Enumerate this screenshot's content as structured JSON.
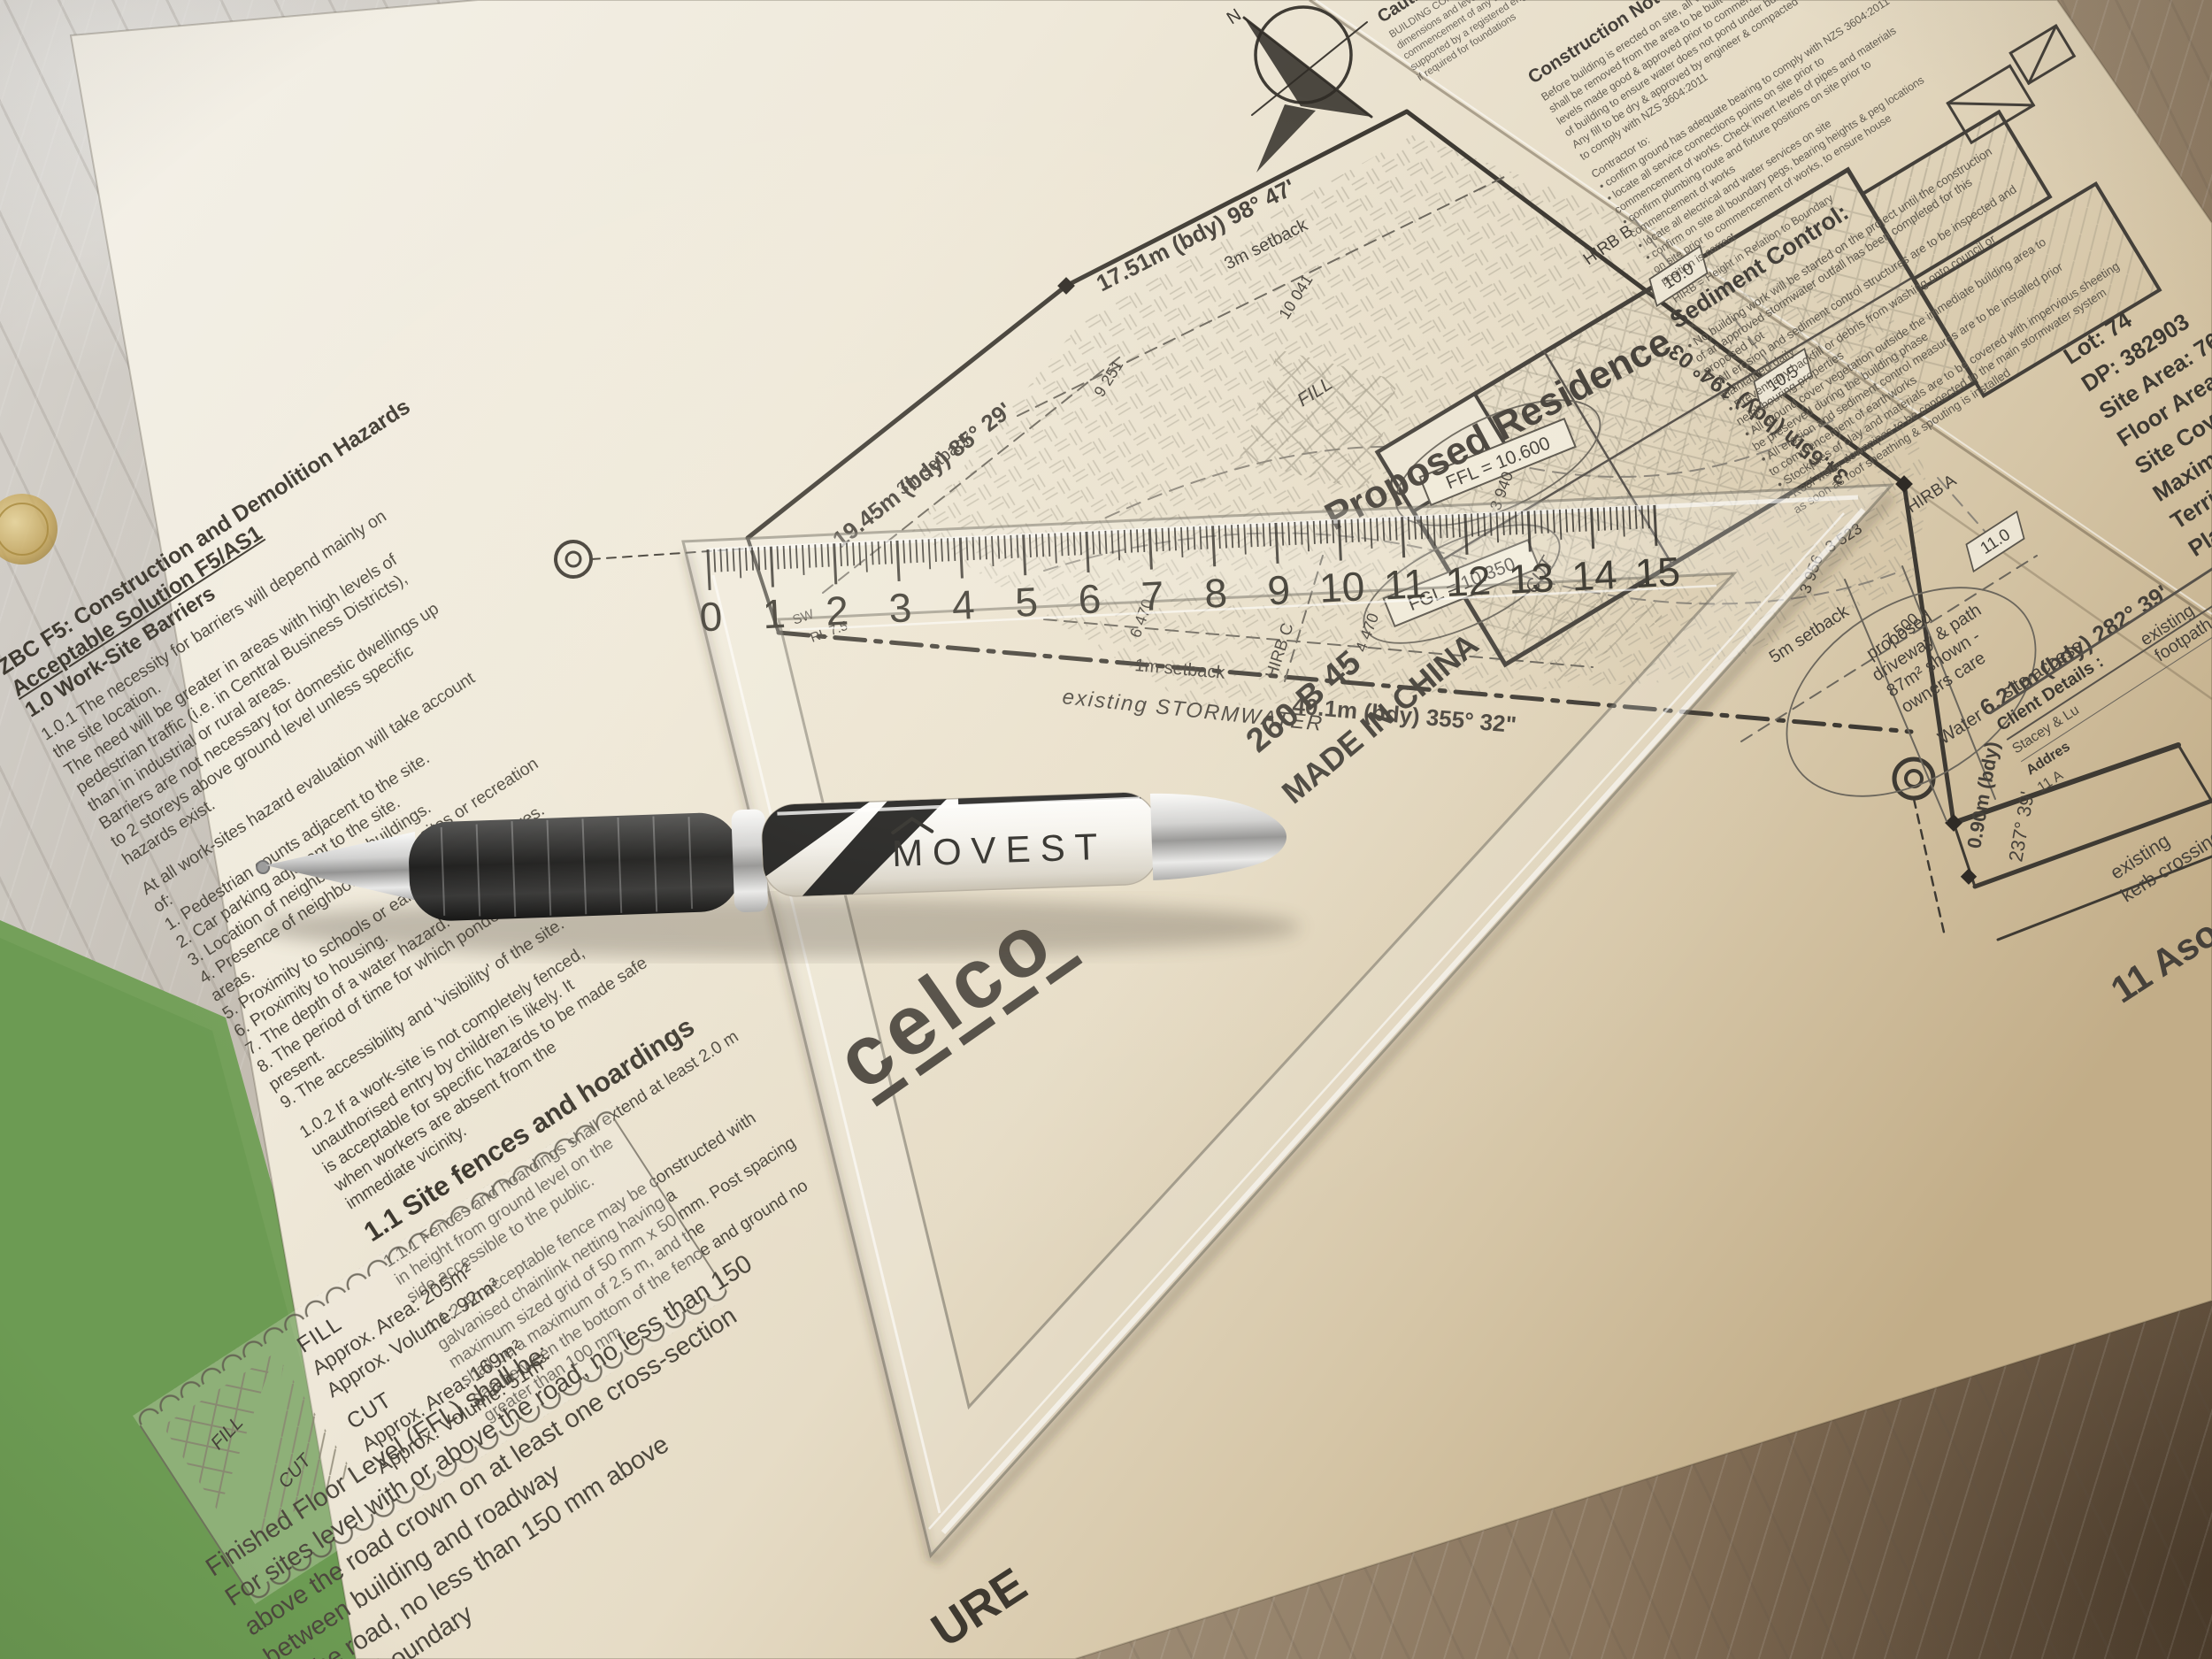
{
  "code_page": {
    "title": "ZBC F5: Construction and Demolition Hazards",
    "subtitle": "Acceptable Solution F5/AS1",
    "section": "1.0 Work-Site Barriers",
    "para_101": "1.0.1 The necessity for barriers will depend mainly on\nthe site location.\nThe need will be greater in areas with high levels of\npedestrian traffic (i.e. in Central Business Districts),\nthan in industrial or rural areas.\nBarriers are not necessary for domestic dwellings up\nto 2 storeys above ground level unless specific\nhazards exist.",
    "eval_intro": "At all work-sites hazard evaluation will take account\nof:",
    "eval_items": [
      "1. Pedestrian counts adjacent to the site.",
      "2. Car parking adjacent to the site.",
      "3. Location of neighbouring buildings.",
      "4. Presence of neighbouring work-sites or recreation\nareas.",
      "5. Proximity to schools or early childhood centres.",
      "6. Proximity to housing.",
      "7. The depth of a water hazard.",
      "8. The period of time for which ponded water will be\npresent.",
      "9. The accessibility and 'visibility' of the site."
    ],
    "para_102": "1.0.2 If a work-site is not completely fenced,\nunauthorised entry by children is likely. It\nis acceptable for specific hazards to be made safe\nwhen workers are absent from the\nimmediate vicinity.",
    "fences_heading": "1.1 Site fences and hoardings",
    "para_111": "1.1.1 Fences and hoardings shall extend at least 2.0 m\nin height from ground level on the\nside accessible to the public.",
    "para_112": "1.1.2 An acceptable fence may be constructed with\ngalvanised chainlink netting having a\nmaximum sized grid of 50 mm x 50 mm. Post spacing\nshall be a maximum of 2.5 m, and the\ngap between the bottom of the fence and ground no\ngreater than 100 mm."
  },
  "legend": {
    "fill_label": "FILL",
    "fill_area": "Approx. Area: 205m²",
    "fill_volume": "Approx. Volume: 92m³",
    "cut_label": "CUT",
    "cut_area": "Approx. Area: 169m²",
    "cut_volume": "Approx. Volume: 51m³",
    "fill_swatch": "FILL",
    "cut_swatch": "CUT"
  },
  "ffl_notes": {
    "lines": [
      "Finished Floor Level (FFL) shall be:",
      "For sites level with or above the road, no less than 150",
      "above the road crown on at least one cross-section",
      "between building and roadway",
      "or the road, no less than 150 mm above",
      "the site boundary"
    ],
    "clipped_word": "URE"
  },
  "site_plan": {
    "labels": {
      "proposed_residence": "Proposed Residence",
      "ffl": "FFL = 10.600",
      "fgl": "FGL = 10.350",
      "stormwater": "existing STORMWATER",
      "bdy_south": "40.1m (bdy) 355° 32\"",
      "bdy_west": "19.45m (bdy) 85° 29'",
      "bdy_north": "17.51m (bdy) 98° 47'",
      "bdy_east": "34.65m (bdy) 194° 03'",
      "bdy_front": "6.21m (bdy) 282° 39'",
      "bdy_small": "0.90m (bdy)",
      "bdy_small_bearing": "237° 39'",
      "setback_3m_a": "3m setback",
      "setback_3m_b": "3m setback",
      "setback_1m": "1m setback",
      "setback_5m": "5m setback",
      "hirb_a": "HIRB A",
      "hirb_b": "HIRB B",
      "hirb_c": "HIRB C",
      "dim_9251": "9 251",
      "dim_10041": "10 041",
      "dim_6470": "6 470",
      "dim_4470": "4 470",
      "dim_7500": "7 500",
      "dim_3523": "3 523",
      "dim_3940": "3 940",
      "dim_3956": "3 956",
      "contour_100": "10.0",
      "contour_105": "10.5",
      "contour_110": "11.0",
      "fill": "FILL",
      "cut": "CUT",
      "driveway_1": "proposed",
      "driveway_2": "driveway & path",
      "driveway_3": "87m² shown -",
      "driveway_4": "owners care",
      "water": "Water",
      "site_access": "site access",
      "footpath_1": "existing",
      "footpath_2": "footpath",
      "kerb_1": "existing",
      "kerb_2": "kerb crossing",
      "street": "11 Aso",
      "sw": "SW",
      "rl": "RL 7.5"
    }
  },
  "notes_page": {
    "caution_heading": "Caution:",
    "caution_lines": [
      "BUILDING CONTRACTOR shall verify all",
      "dimensions and levels on site prior to",
      "commencement of any work & shall be",
      "supported by a registered engineer",
      "if required for foundations"
    ],
    "construction_heading": "Construction Notes:",
    "construction_lines": [
      "Before building is erected on site, all vegetation & topsoil",
      "shall be removed from the area to be built on & ground",
      "levels made good & approved prior to commencement",
      "of building to ensure water does not pond under building.",
      "Any fill to be dry & approved by engineer & compacted",
      "to comply with NZS 3604:2011"
    ],
    "contractor_intro": "Contractor to:",
    "contractor_items": [
      "• confirm ground has adequate bearing to comply with NZS 3604:2011",
      "• locate all service connections points on site prior to",
      "  commencement of works. Check invert levels of pipes and materials",
      "• confirm plumbing route and fixture positions on site prior to",
      "  commencement of works",
      "• locate all electrical and water services on site",
      "• confirm on site all boundary pegs, bearing heights & peg locations",
      "  on site prior to commencement of works, to ensure house",
      "  position is correct"
    ],
    "hirb_note": "HIRB = Height in Relation to Boundary",
    "sediment_heading": "Sediment Control:",
    "sediment_items": [
      "• No building work will be started on the project until the construction",
      "  of an approved stormwater outfall has been completed for this",
      "  proposed Lot",
      "• All erosion and sediment control structures are to be inspected and",
      "  maintained daily",
      "• Prevent any backfill or debris from washing onto council or",
      "  neighbouring properties",
      "• All ground cover vegetation outside the immediate building area to",
      "  be preserved during the building phase",
      "• All erosion and sediment control measures are to be installed prior",
      "  to commencement of earthworks",
      "• Stockpiles of clay and materials are to be covered with impervious sheeting",
      "• Roof water downpipes to be connected to the main stormwater system",
      "  as soon as roof sheathing & spouting is installed"
    ],
    "site_data_lines": [
      "Lot:  74",
      "DP:  382903",
      "Site Area:  765m²",
      "Floor Area:  157",
      "Site Coverage:  2",
      "Maximum Building H",
      "Territorial Auth",
      "Planni"
    ],
    "client": {
      "heading": "Client Details :",
      "name": "Stacey & Lu",
      "address_label": "Addres",
      "address": "11 A"
    }
  },
  "set_square": {
    "brand": "celco",
    "model": "260 B 45",
    "origin": "MADE IN CHINA",
    "numbers": [
      "0",
      "1",
      "2",
      "3",
      "4",
      "5",
      "6",
      "7",
      "8",
      "9",
      "10",
      "11",
      "12",
      "13",
      "14",
      "15"
    ]
  },
  "pen": {
    "brand": "MOVEST"
  },
  "compass": {
    "north_label": "N"
  }
}
